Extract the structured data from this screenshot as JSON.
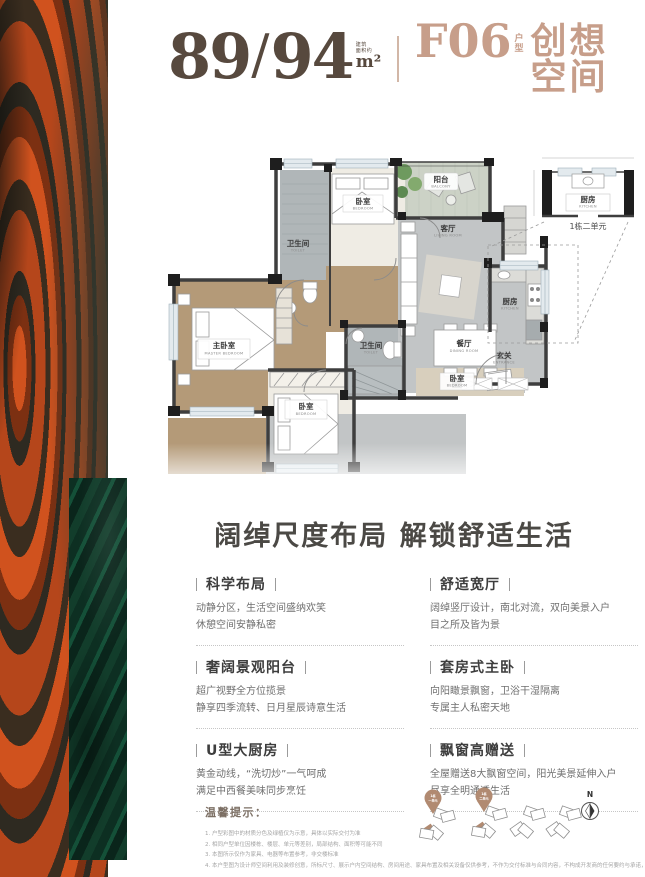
{
  "header": {
    "area_main": "89",
    "area_sep": "/",
    "area_alt": "94",
    "area_note_1": "建筑",
    "area_note_2": "面积约",
    "area_unit": "m²",
    "plan_code": "F06",
    "code_suffix_1": "户",
    "code_suffix_2": "型",
    "plan_name": "创想空间",
    "accent_color": "#c79e8a",
    "number_color": "#57493e"
  },
  "plan": {
    "rooms": {
      "balcony": {
        "cn": "阳台",
        "en": "BALCONY"
      },
      "bedroom_top": {
        "cn": "卧室",
        "en": "BEDROOM"
      },
      "toilet_top": {
        "cn": "卫生间",
        "en": "TOILET"
      },
      "living": {
        "cn": "客厅",
        "en": "LIVING ROOM"
      },
      "master": {
        "cn": "主卧室",
        "en": "MASTER BEDROOM"
      },
      "bedroom_mid": {
        "cn": "卧室",
        "en": "BEDROOM"
      },
      "toilet_mid": {
        "cn": "卫生间",
        "en": "TOILET"
      },
      "dining": {
        "cn": "餐厅",
        "en": "DINING ROOM"
      },
      "bedroom_right": {
        "cn": "卧室",
        "en": "BEDROOM"
      },
      "kitchen": {
        "cn": "厨房",
        "en": "KITCHEN"
      },
      "entrance": {
        "cn": "玄关",
        "en": "ENTRANCE"
      }
    },
    "inset": {
      "kitchen_cn": "厨房",
      "kitchen_en": "KITCHEN",
      "caption": "1栋二单元"
    }
  },
  "headline": "阔绰尺度布局  解锁舒适生活",
  "features": [
    {
      "title": "科学布局",
      "line1": "动静分区，生活空间盛纳欢笑",
      "line2": "休憩空间安静私密"
    },
    {
      "title": "舒适宽厅",
      "line1": "阔绰竖厅设计，南北对流，双向美景入户",
      "line2": "目之所及皆为景"
    },
    {
      "title": "奢阔景观阳台",
      "line1": "超广视野全方位揽景",
      "line2": "静享四季流转、日月星辰诗意生活"
    },
    {
      "title": "套房式主卧",
      "line1": "向阳瞰景飘窗，卫浴干湿隔离",
      "line2": "专属主人私密天地"
    },
    {
      "title": "U型大厨房",
      "line1": "黄金动线，“洗切炒”一气呵成",
      "line2": "满足中西餐美味同步烹饪"
    },
    {
      "title": "飘窗高赠送",
      "line1": "全屋赠送8大飘窗空间，阳光美景延伸入户",
      "line2": "尽享全明通透生活"
    }
  ],
  "tips": {
    "title": "温馨提示：",
    "lines": [
      "1. 户型彩图中的材质分色及绿植仅为示意，具体以实际交付为准",
      "2. 相同户型单位因楼栋、楼层、单元等差别，局部结构、面积等可能不同",
      "3. 本图所示仅作为家具、电器等布置参考，非交楼标准",
      "4. 本户型图为设计师空间利用及装修创意，所标尺寸、展示户内空间结构、房间用途、家具布置及相关设备仅供参考，不作为交付标准与合同内容，不构成开发商的任何要约与承诺，且不得加、改、扩建"
    ]
  },
  "site": {
    "pins": [
      {
        "line1": "1栋",
        "line2": "一单元"
      },
      {
        "line1": "1栋",
        "line2": "二单元"
      }
    ],
    "compass": "N"
  }
}
